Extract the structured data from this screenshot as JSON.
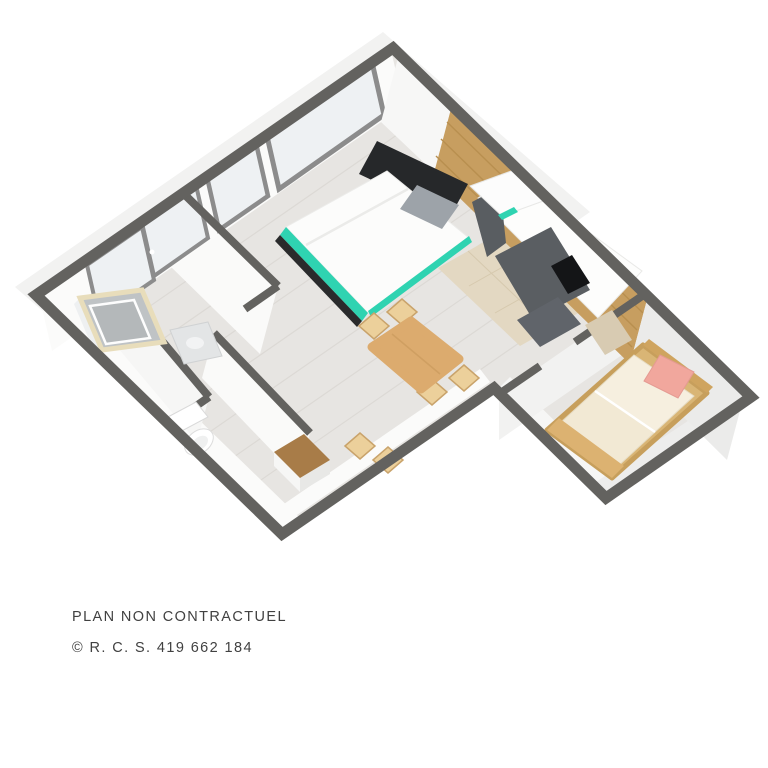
{
  "footer": {
    "line1": "PLAN NON CONTRACTUEL",
    "line2": "© R. C. S. 419 662 184"
  },
  "palette": {
    "wall": "#63625f",
    "floor": "#e7e5e2",
    "slab": "#f2f2f1",
    "wood_wall": "#c79e60",
    "accent_teal": "#2fd3b1",
    "accent_pink": "#f1a79d",
    "furniture_wood": "#dcab6e",
    "chair_wood": "#ecd09b",
    "counter_white": "#fdfdfc",
    "cabinet_gray": "#5a5e62",
    "cooktop_black": "#141517",
    "mattress_cream": "#f2e9d4",
    "bed_white": "#fcfcfb",
    "pillow_gray": "#9da3a9",
    "glass": "#eef1f3",
    "window_frame": "#8c8c8c",
    "text": "#414141"
  }
}
